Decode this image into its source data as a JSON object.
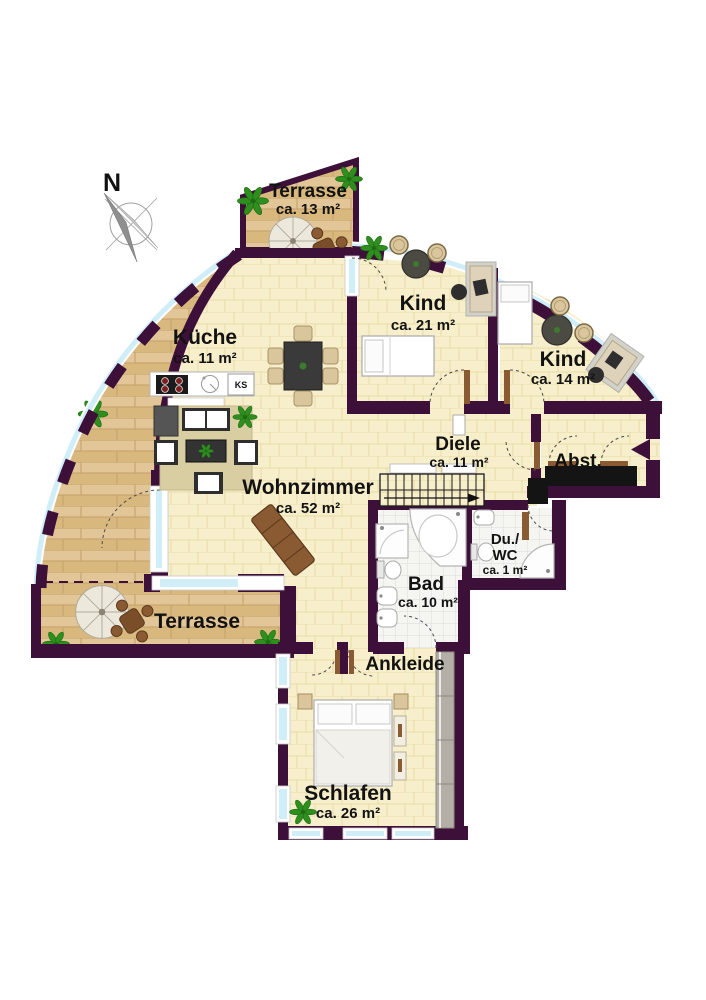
{
  "compass": {
    "label": "N"
  },
  "rooms": {
    "terrasse_top": {
      "name": "Terrasse",
      "area": "ca. 13 m²"
    },
    "kueche": {
      "name": "Küche",
      "area": "ca. 11 m²"
    },
    "kind_gross": {
      "name": "Kind",
      "area": "ca. 21 m²"
    },
    "kind_klein": {
      "name": "Kind",
      "area": "ca. 14 m²"
    },
    "wohnzimmer": {
      "name": "Wohnzimmer",
      "area": "ca. 52 m²"
    },
    "diele": {
      "name": "Diele",
      "area": "ca. 11 m²"
    },
    "abstellraum": {
      "name": "Abst."
    },
    "dusche_wc": {
      "name_line1": "Du./",
      "name_line2": "WC",
      "area": "ca. 1 m²"
    },
    "bad": {
      "name": "Bad",
      "area": "ca. 10 m²"
    },
    "terrasse_unten": {
      "name": "Terrasse"
    },
    "ankleide": {
      "name": "Ankleide"
    },
    "schlafen": {
      "name": "Schlafen",
      "area": "ca. 26 m²"
    }
  },
  "kitchen": {
    "fridge_label": "KS"
  },
  "colors": {
    "wall": "#3d1039",
    "parquet": "#f7eecb",
    "terrace_wood": "#debf8c",
    "glass": "#cfeef8",
    "tile": "#f4f4f1",
    "plant": "#2e8f1f",
    "wood_furniture": "#8a5a33"
  }
}
